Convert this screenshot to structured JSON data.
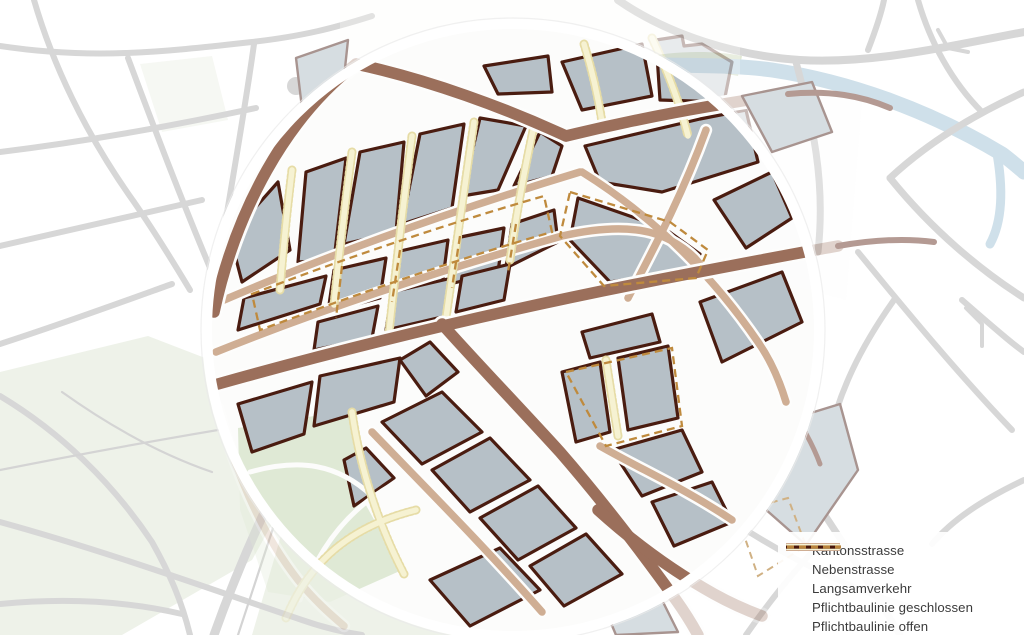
{
  "legend": {
    "items": [
      {
        "id": "kantonsstrasse",
        "label": "Kantonsstrasse",
        "color": "#9b6f5b",
        "swatch": "bar-thick"
      },
      {
        "id": "nebenstrasse",
        "label": "Nebenstrasse",
        "color": "#cfae94",
        "swatch": "bar-thick"
      },
      {
        "id": "langsamverkehr",
        "label": "Langsamverkehr",
        "color": "#f6f2d4",
        "swatch": "bar-thin"
      },
      {
        "id": "pflichtbaulinie-geschlossen",
        "label": "Pflichtbaulinie geschlossen",
        "color": "#47160a",
        "swatch": "line-solid"
      },
      {
        "id": "pflichtbaulinie-offen",
        "label": "Pflichtbaulinie offen",
        "color": "#b9843c",
        "swatch": "line-dashed"
      }
    ]
  },
  "map": {
    "palette": {
      "kanton": "#9b6f5b",
      "neben": "#cfae94",
      "lang": "#f6f2d2",
      "langedge": "#e6dca6",
      "open": "#bf8a3d",
      "outline": "#4a1c10",
      "block": "#b6c0c7",
      "fadedblock": "#d6dde1",
      "fadedline": "#a89490",
      "mauve": "#b49a93",
      "road": "#d7d7d7",
      "roadthin": "#d4d4d4",
      "river": "#cfe0ea",
      "field": "#eef2e9",
      "park": "#dfe9d5",
      "base": "#fcfcfb",
      "ring": "#ffffff",
      "text": "#3b3b3b"
    }
  }
}
